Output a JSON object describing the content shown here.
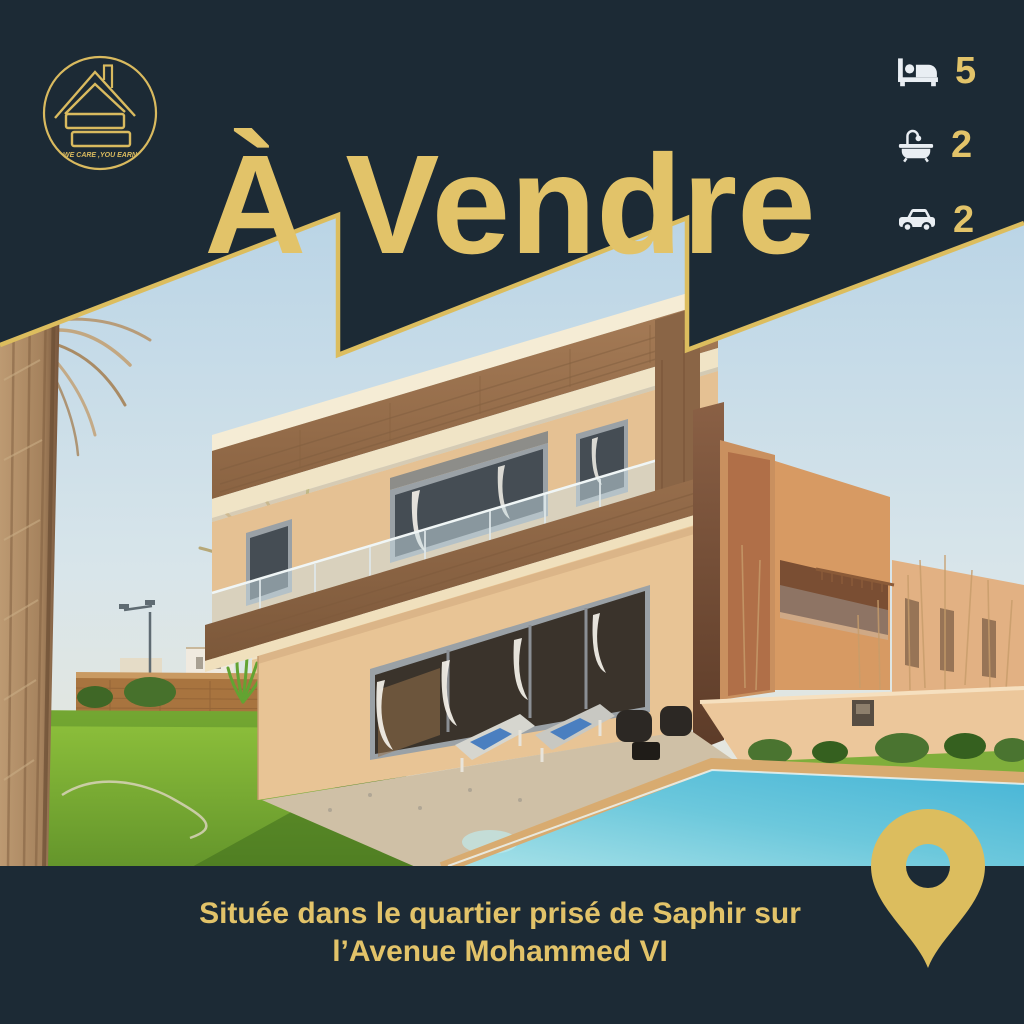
{
  "poster": {
    "title": "À Vendre"
  },
  "logo": {
    "icon": "house-s-logo",
    "motto": "WE CARE ,YOU EARN"
  },
  "specs": [
    {
      "icon": "bed-icon",
      "value": "5"
    },
    {
      "icon": "bathtub-icon",
      "value": "2"
    },
    {
      "icon": "car-icon",
      "value": "2"
    }
  ],
  "address": {
    "line1": "Située dans le quartier prisé de Saphir sur",
    "line2": "l’Avenue Mohammed VI"
  },
  "map_pin_icon": "location-pin-icon",
  "colors": {
    "background_navy": "#1c2a35",
    "accent_gold": "#e2c369",
    "icon_white": "#e9eef3"
  }
}
